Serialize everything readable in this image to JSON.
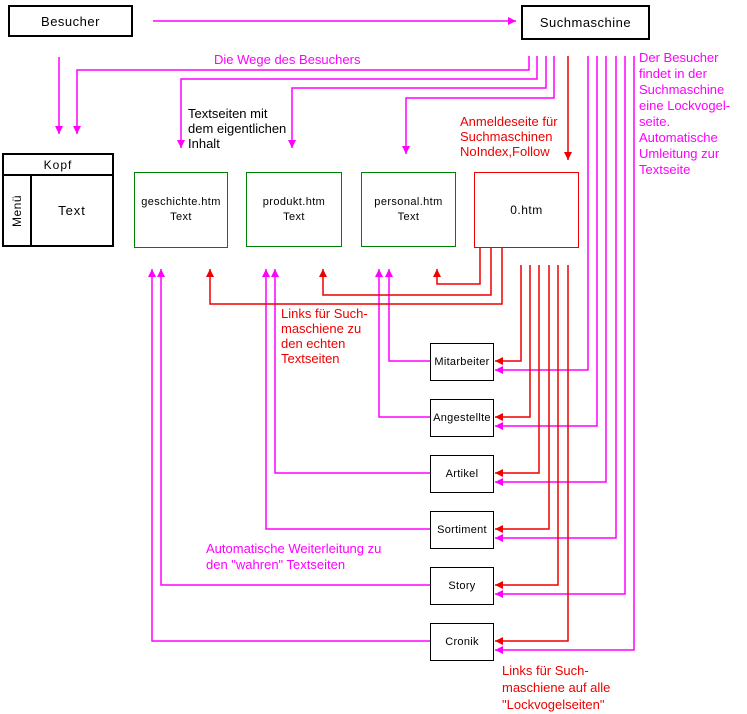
{
  "colors": {
    "magenta": "#ff00ff",
    "red": "#ee0000",
    "green": "#008000",
    "black": "#000000",
    "bg": "#ffffff"
  },
  "nodes": {
    "besucher": "Besucher",
    "suchmaschine": "Suchmaschine",
    "wireframe": {
      "kopf": "Kopf",
      "menue": "Menü",
      "text": "Text"
    },
    "text_pages": [
      {
        "name": "geschichte.htm",
        "sub": "Text"
      },
      {
        "name": "produkt.htm",
        "sub": "Text"
      },
      {
        "name": "personal.htm",
        "sub": "Text"
      }
    ],
    "decoy_page": "0.htm",
    "lockvogel_pages": [
      "Mitarbeiter",
      "Angestellte",
      "Artikel",
      "Sortiment",
      "Story",
      "Cronik"
    ]
  },
  "labels": {
    "wege": "Die Wege des Besuchers",
    "textseiten": "Textseiten mit\ndem eigentlichen\nInhalt",
    "anmeldeseite": "Anmeldeseite für\nSuchmaschinen\nNoIndex,Follow",
    "besucher_findet": "Der Besucher\nfindet in der\nSuchmaschine\neine Lockvogel-\nseite.\nAutomatische\nUmleitung zur\nTextseite",
    "links_echte": "Links für Such-\nmaschiene zu\nden echten\nTextseiten",
    "weiterleitung": "Automatische Weiterleitung zu\nden \"wahren\" Textseiten",
    "links_lockvogel": "Links für Such-\nmaschiene auf alle\n\"Lockvogelseiten\""
  }
}
